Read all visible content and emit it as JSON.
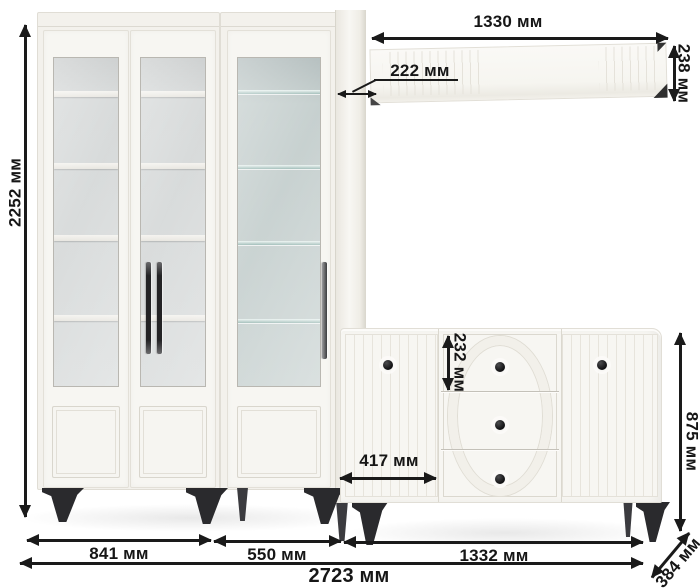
{
  "diagram_type": "furniture-dimension-diagram",
  "unit": "мм",
  "dims": {
    "total_height": "2252 мм",
    "total_width": "2723 мм",
    "left_cabinet_width": "841 мм",
    "right_cabinet_width": "550 мм",
    "sideboard_width": "1332 мм",
    "sideboard_height": "875 мм",
    "sideboard_depth": "384 мм",
    "left_door_width": "417 мм",
    "top_drawer_height": "232 мм",
    "shelf_width": "1330 мм",
    "shelf_depth": "222 мм",
    "shelf_height": "238 мм"
  },
  "colors": {
    "background": "#ffffff",
    "dimension_lines": "#1a1a1a",
    "furniture_body": "#f7f6f2",
    "furniture_edges": "#e1ded6",
    "cabinet_interior": "#d8dbdb",
    "glass_teal": "#c4cecd",
    "legs_and_knobs": "#2a2a2d"
  }
}
